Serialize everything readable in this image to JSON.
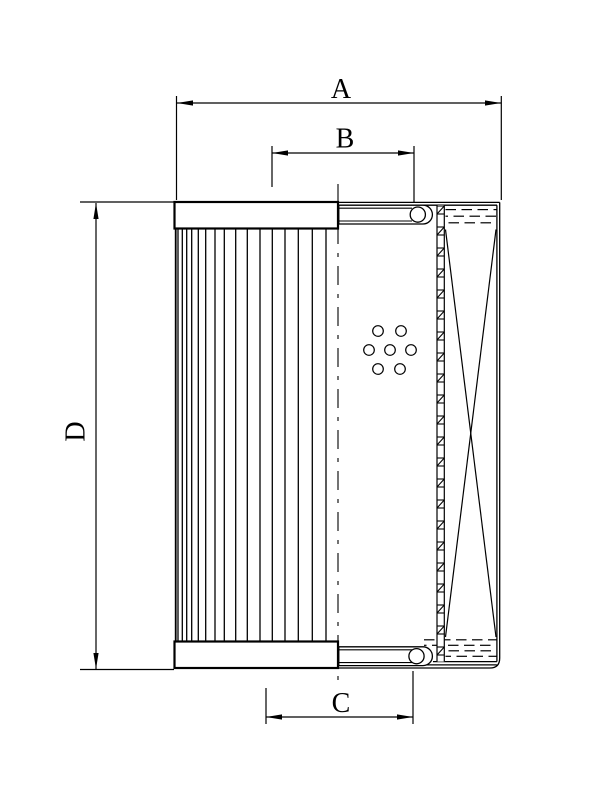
{
  "canvas": {
    "background_color": "#ffffff",
    "line_color": "#000000"
  },
  "drawing": {
    "kind": "technical dimensional drawing of a filter element (half exterior view, half section)",
    "dimensions": {
      "A": {
        "label": "A",
        "axis": "horizontal"
      },
      "B": {
        "label": "B",
        "axis": "horizontal"
      },
      "C": {
        "label": "C",
        "axis": "horizontal"
      },
      "D": {
        "label": "D",
        "axis": "vertical"
      }
    }
  }
}
